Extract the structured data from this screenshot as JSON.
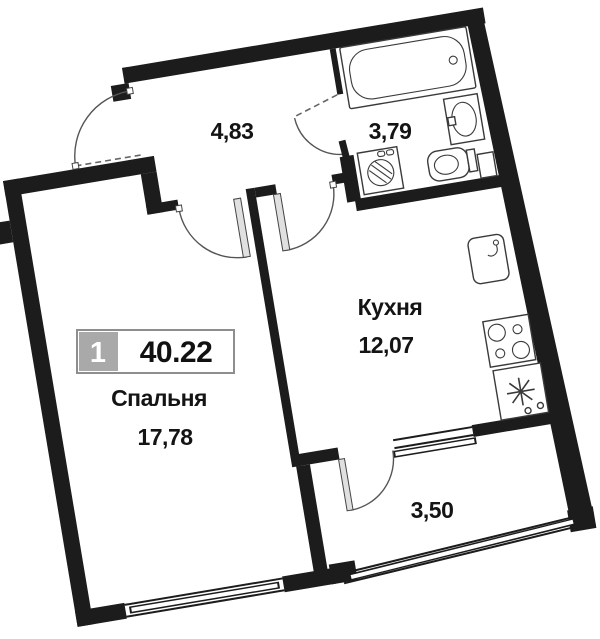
{
  "plan_title": "apartment-floor-plan",
  "badge": {
    "number": "1",
    "area_total": "40.22"
  },
  "rooms": {
    "bedroom": {
      "label": "Спальня",
      "area": "17,78"
    },
    "kitchen": {
      "label": "Кухня",
      "area": "12,07"
    },
    "hallway": {
      "area": "4,83"
    },
    "bathroom": {
      "area": "3,79"
    },
    "balcony": {
      "area": "3,50"
    }
  },
  "fixtures": [
    "bathtub-icon",
    "wash-basin-icon",
    "toilet-icon",
    "washing-machine-icon",
    "kitchen-sink-icon",
    "stove-icon",
    "fridge-icon",
    "vent-duct"
  ],
  "colors": {
    "background": "#ffffff",
    "wall": "#1c1c1c",
    "door_line": "#555555",
    "fixture_line": "#3a3a3a",
    "badge_grey": "#a9a9a9",
    "badge_border": "#8e8e8e",
    "text": "#141414"
  }
}
